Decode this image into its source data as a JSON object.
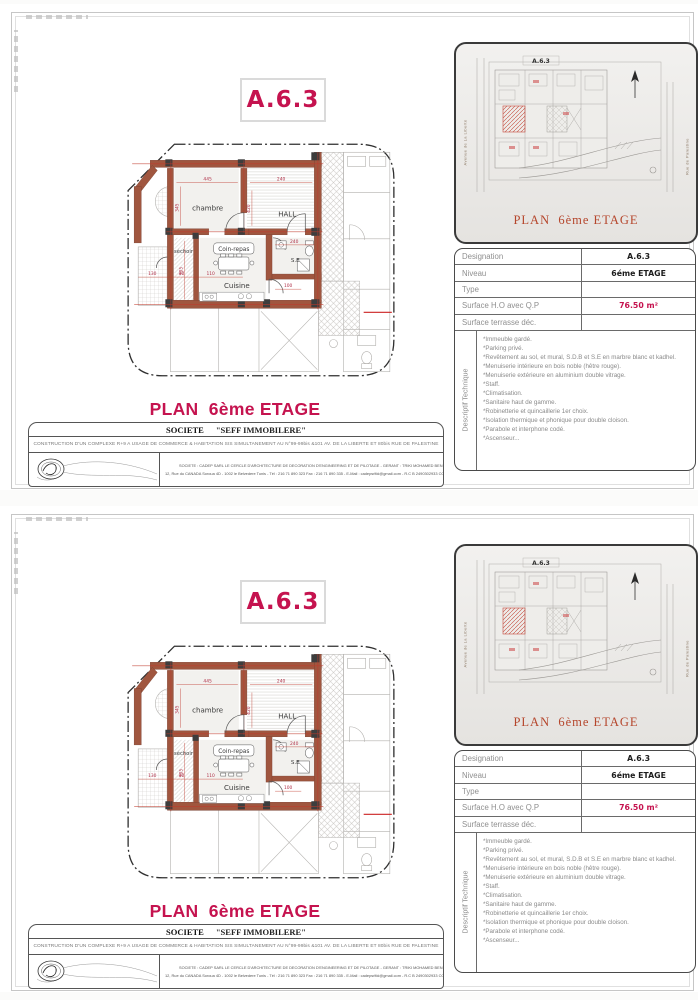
{
  "colors": {
    "crimson": "#c5134f",
    "brick_red": "#b5462c",
    "wall_brown": "#a0563f",
    "dim_red": "#c0392b"
  },
  "sheet": {
    "unit_code": "A.6.3",
    "main_title": "PLAN  6ème ETAGE",
    "plan": {
      "rooms": {
        "chambre": "chambre",
        "hall": "HALL",
        "sechoir": "séchoir",
        "coin_repas": "Coin-repas",
        "cuisine": "Cuisine",
        "se": "S.E"
      },
      "dims": {
        "chambre_w": "445",
        "hall_w": "240",
        "chambre_h": "345",
        "hall_h": "420",
        "sechoir_a": "130",
        "sechoir_b": "40",
        "sechoir_c": "110",
        "sechoir_h": "305",
        "se_w": "240",
        "se_b": "100"
      }
    },
    "inset": {
      "unit_code": "A.6.3",
      "caption": "PLAN  6ème ETAGE",
      "street_left": "Avenue de La Liberté",
      "street_right": "Rue de Palestine"
    },
    "designation_table": {
      "rows": [
        {
          "label": "Designation",
          "value": "A.6.3"
        },
        {
          "label": "Niveau",
          "value": "6éme ETAGE"
        },
        {
          "label": "Type",
          "value": ""
        },
        {
          "label": "Surface H.O avec Q.P",
          "value": "76.50 m²"
        },
        {
          "label": "Surface terrasse déc.",
          "value": ""
        }
      ]
    },
    "descriptif": {
      "label": "Descriptif Technique",
      "items": [
        "*Immeuble gardé.",
        "*Parking privé.",
        "*Revêtement au sol, et mural, S.D.B et S.E en marbre blanc et kadhel.",
        "*Menuiserie intérieure en bois noble (hêtre rouge).",
        "*Menuiserie extérieure en aluminium double vitrage.",
        "*Staff.",
        "*Climatisation.",
        "*Sanitaire haut de gamme.",
        "*Robinetterie et quincaillerie 1er choix.",
        "*Isolation thermique et phonique pour double cloison.",
        "*Parabole et interphone codé.",
        "*Ascenseur..."
      ]
    },
    "societe": {
      "name_label": "SOCIETE",
      "name_value": "\"SEFF IMMOBILERE\"",
      "description": "CONSTRUCTION D'UN COMPLEXE R+9 A USAGE DE COMMERCE & HABITATION SIS SIMULTANEMENT AU N°99-99bis &101 AV. DE LA LIBERTE  ET 80bis RUE DE PALESTINE",
      "firm_line1": "SOCIETE :  CADEP  SARL LE CERCLE D'ARCHITECTURE DE DECORATION D'ENGINEERING ET DE PILOTAGE - GERANT : TRIKI MOHAMED BEN AHMED ARCHITECTE",
      "firm_line2": "12, Rue du CANADA Soroua 4D - 1002 le Belvedere Tunis - Tél : 216 71 890 323  Fax : 216 71 890 335 - E-Mail : cadepsrltki@gmail.com - R.C B 2490302933 CODE T.V.A : 1282339 P/A/M/000"
    }
  }
}
